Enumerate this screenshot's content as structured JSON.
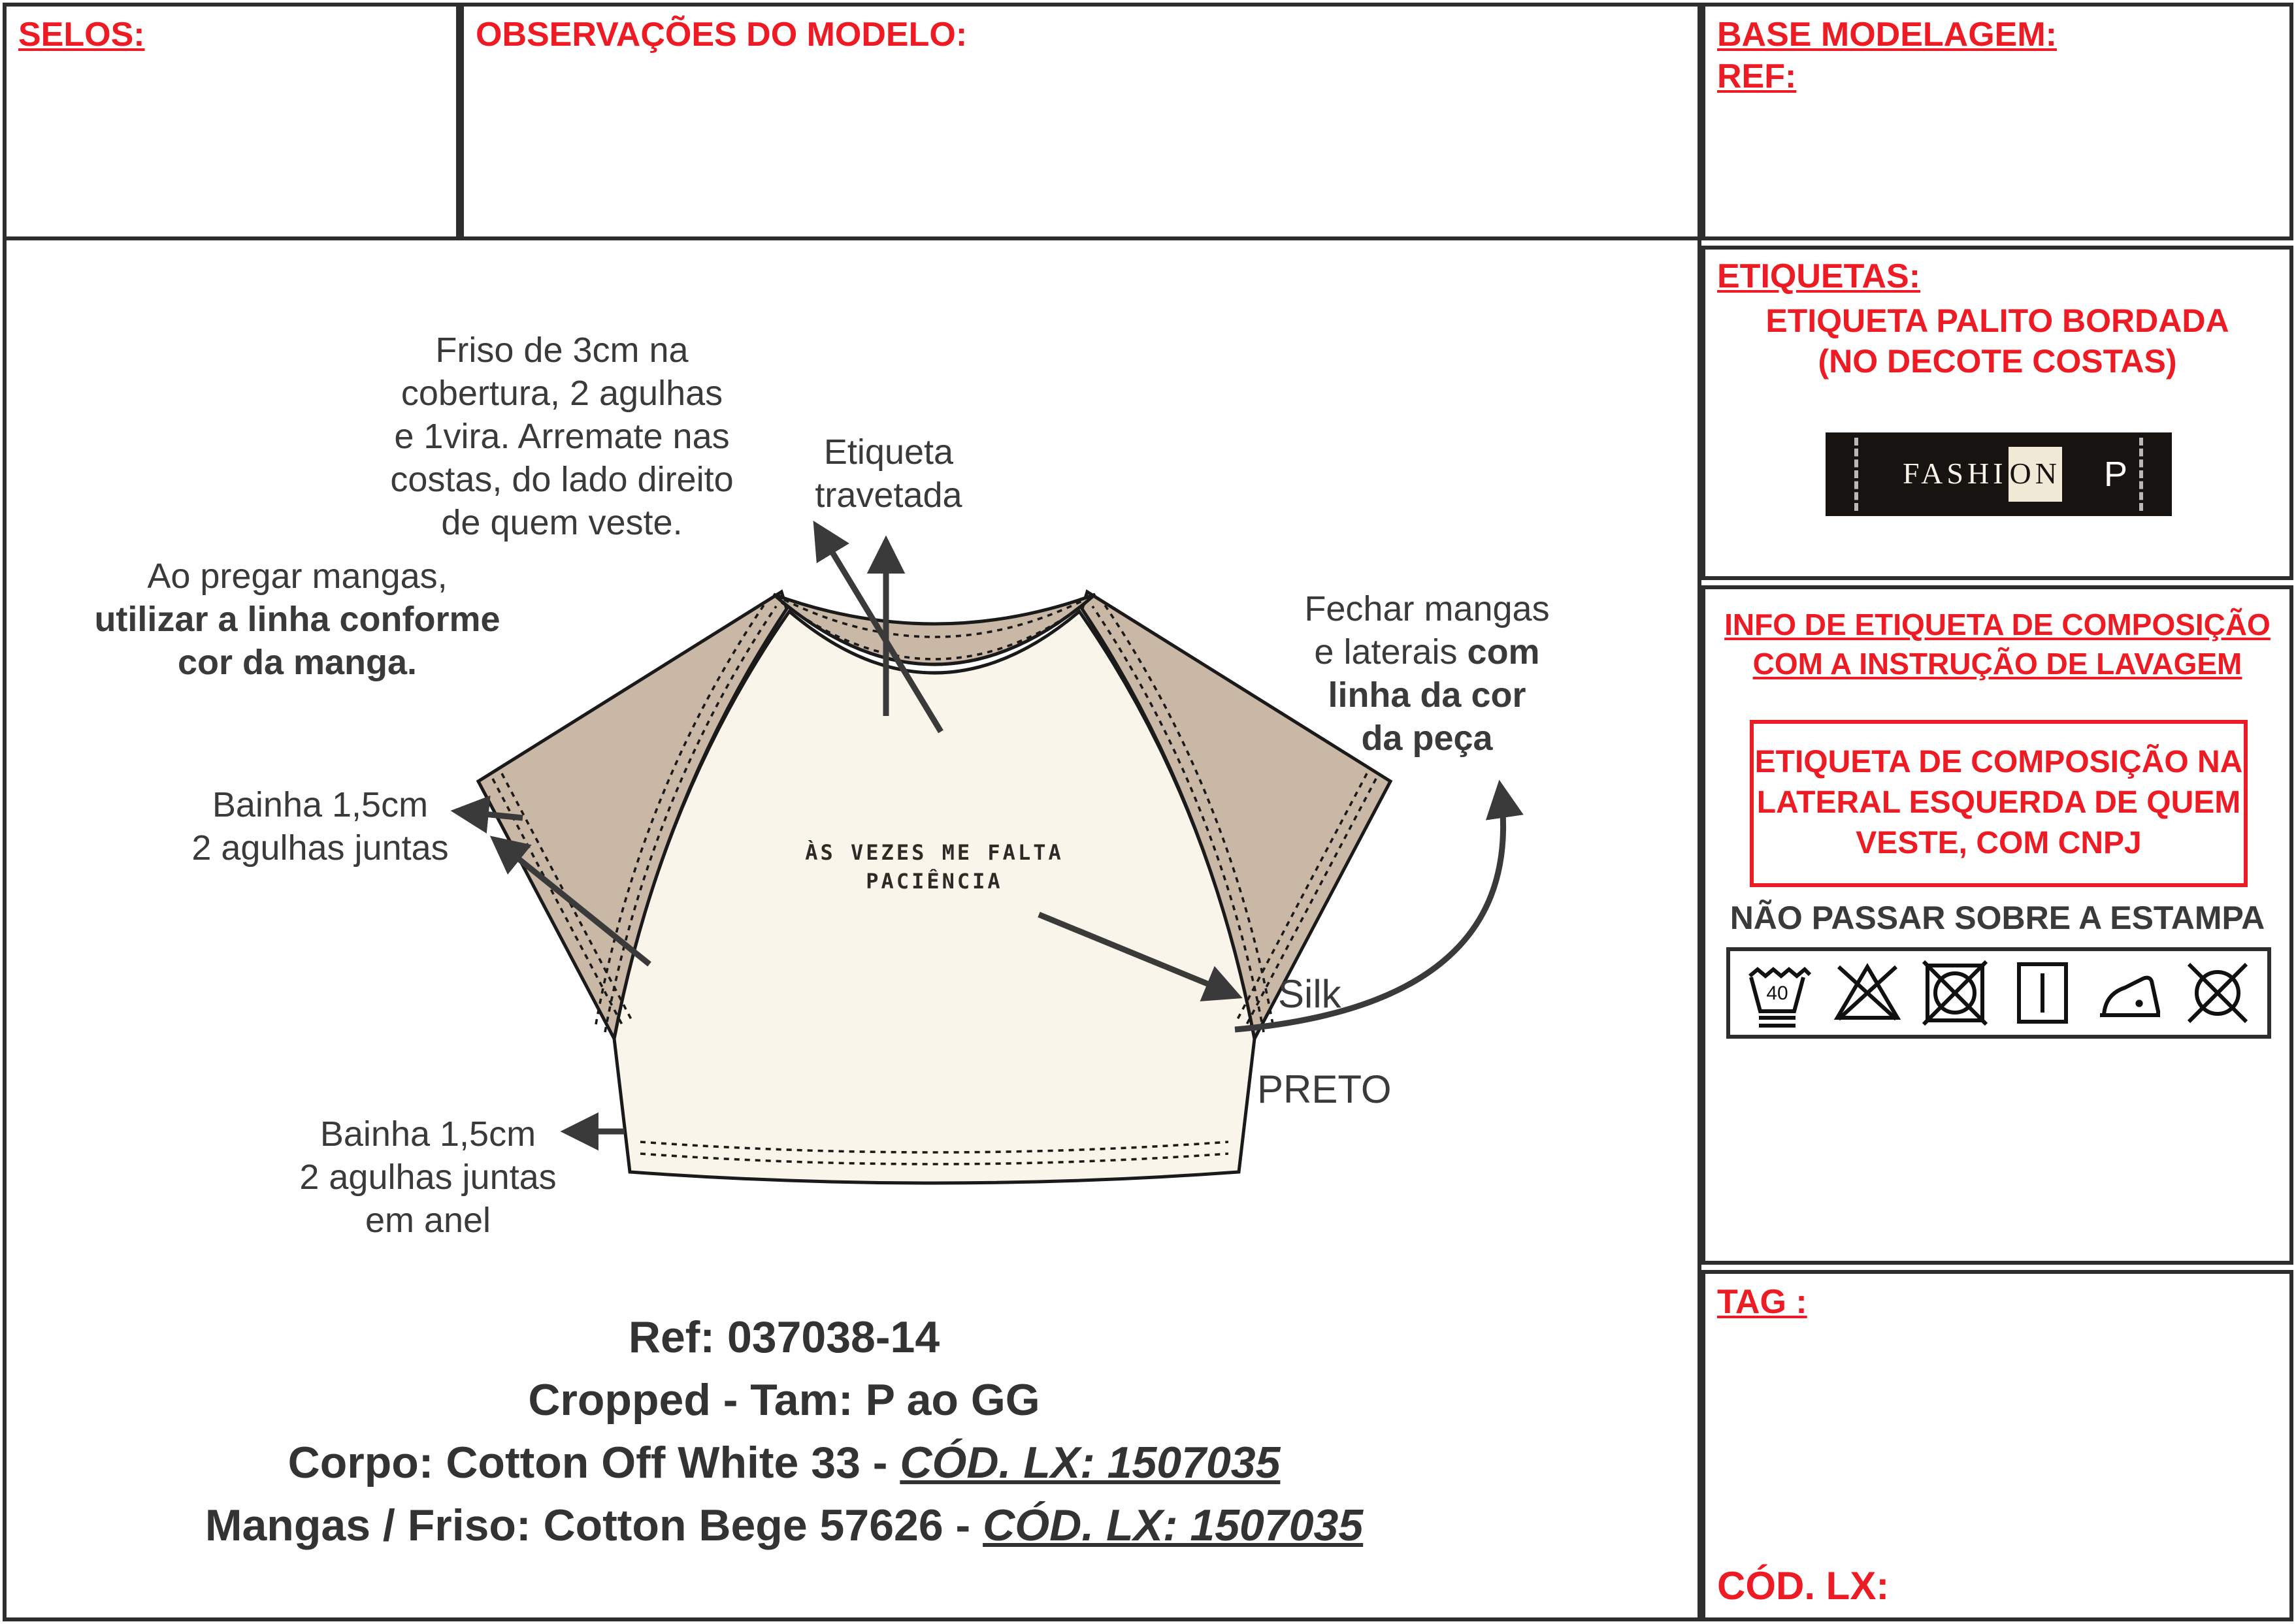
{
  "panels": {
    "selos": {
      "title": "SELOS:"
    },
    "observacoes": {
      "title": "OBSERVAÇÕES DO MODELO:"
    },
    "base_modelagem": {
      "title": "BASE MODELAGEM:",
      "ref_label": "REF:"
    },
    "etiquetas": {
      "title": "ETIQUETAS:",
      "subtitle_line1": "ETIQUETA PALITO BORDADA",
      "subtitle_line2": "(NO DECOTE COSTAS)",
      "label_preview": {
        "brand_part1": "FASHI",
        "brand_part2": "ON",
        "size": "P"
      }
    },
    "info_composicao": {
      "title_line1": "INFO DE ETIQUETA DE COMPOSIÇÃO",
      "title_line2": "COM A INSTRUÇÃO DE LAVAGEM",
      "box_line1": "ETIQUETA DE COMPOSIÇÃO NA",
      "box_line2": "LATERAL ESQUERDA DE QUEM",
      "box_line3": "VESTE, COM CNPJ",
      "care_warning": "NÃO PASSAR SOBRE A ESTAMPA",
      "wash_temp": "40",
      "care_symbols": [
        "wash-40-gentle-icon",
        "do-not-bleach-icon",
        "do-not-tumble-dry-icon",
        "line-dry-icon",
        "iron-low-icon",
        "do-not-dry-clean-icon"
      ]
    },
    "tag": {
      "title": "TAG :",
      "cod_lx_label": "CÓD. LX:"
    }
  },
  "drawing": {
    "annotations": {
      "friso": [
        "Friso de 3cm na",
        "cobertura, 2 agulhas",
        "e 1vira. Arremate nas",
        "costas, do lado direito",
        "de quem veste."
      ],
      "etiqueta_travetada": [
        "Etiqueta",
        "travetada"
      ],
      "ao_pregar": {
        "line1": "Ao pregar mangas,",
        "line2": "utilizar a linha conforme",
        "line3": "cor da manga."
      },
      "bainha_manga": [
        "Bainha 1,5cm",
        "2 agulhas juntas"
      ],
      "fechar": {
        "line1": "Fechar mangas",
        "line2_regular": "e laterais ",
        "line2_bold": "com",
        "line3": "linha da cor",
        "line4": "da peça"
      },
      "silk": "Silk",
      "silk_color": "PRETO",
      "bainha_barra": [
        "Bainha 1,5cm",
        "2 agulhas juntas",
        "em anel"
      ]
    },
    "print_text": [
      "ÀS VEZES ME FALTA",
      "PACIÊNCIA"
    ]
  },
  "footer": {
    "line1": "Ref: 037038-14",
    "line2": "Cropped - Tam: P ao GG",
    "line3_regular": "Corpo: Cotton Off White 33 - ",
    "line3_cod": "CÓD. LX: 1507035",
    "line4_regular": "Mangas / Friso: Cotton Bege 57626 - ",
    "line4_cod": "CÓD. LX: 1507035"
  },
  "colors": {
    "red": "#ed1c24",
    "sleeve_beige": "#c9b8a6",
    "body_offwhite": "#faf5ea",
    "ink": "#3a3a3a"
  }
}
